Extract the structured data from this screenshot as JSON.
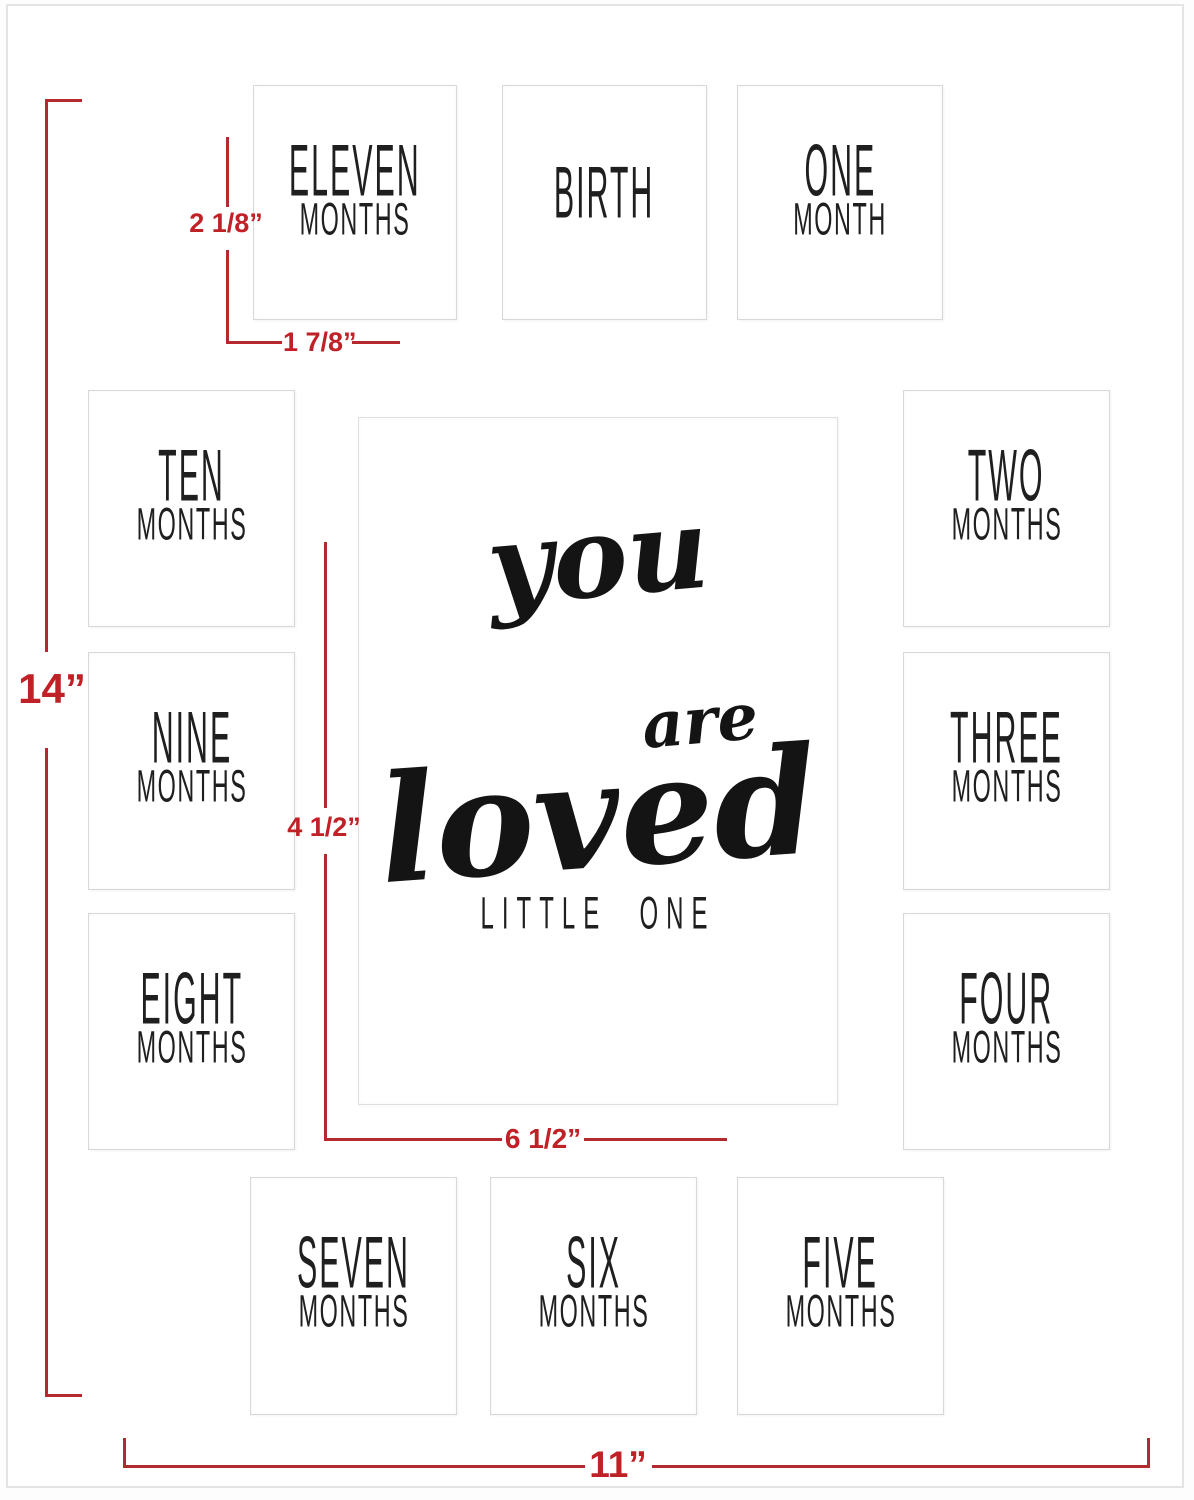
{
  "product": {
    "center_script_line1": "you",
    "center_script_line2": "are",
    "center_script_line3": "loved",
    "center_subtitle": "LITTLE ONE"
  },
  "openings": [
    {
      "id": "eleven-months",
      "line1": "ELEVEN",
      "line2": "MONTHS"
    },
    {
      "id": "birth",
      "line1": "BIRTH",
      "line2": ""
    },
    {
      "id": "one-month",
      "line1": "ONE",
      "line2": "MONTH"
    },
    {
      "id": "ten-months",
      "line1": "TEN",
      "line2": "MONTHS"
    },
    {
      "id": "two-months",
      "line1": "TWO",
      "line2": "MONTHS"
    },
    {
      "id": "nine-months",
      "line1": "NINE",
      "line2": "MONTHS"
    },
    {
      "id": "three-months",
      "line1": "THREE",
      "line2": "MONTHS"
    },
    {
      "id": "eight-months",
      "line1": "EIGHT",
      "line2": "MONTHS"
    },
    {
      "id": "four-months",
      "line1": "FOUR",
      "line2": "MONTHS"
    },
    {
      "id": "seven-months",
      "line1": "SEVEN",
      "line2": "MONTHS"
    },
    {
      "id": "six-months",
      "line1": "SIX",
      "line2": "MONTHS"
    },
    {
      "id": "five-months",
      "line1": "FIVE",
      "line2": "MONTHS"
    }
  ],
  "dimensions": {
    "total_height_label": "14”",
    "total_width_label": "11”",
    "small_opening_height_label": "2 1/8”",
    "small_opening_width_label": "1 7/8”",
    "center_opening_height_label": "4 1/2”",
    "center_opening_width_label": "6 1/2”"
  },
  "colors": {
    "dimension_red": "#c02127",
    "line_red": "#b5282c",
    "text_black": "#1f1f1f",
    "opening_border_gray": "#d8d8d8",
    "mat_border_gray": "#e4e4e4"
  }
}
